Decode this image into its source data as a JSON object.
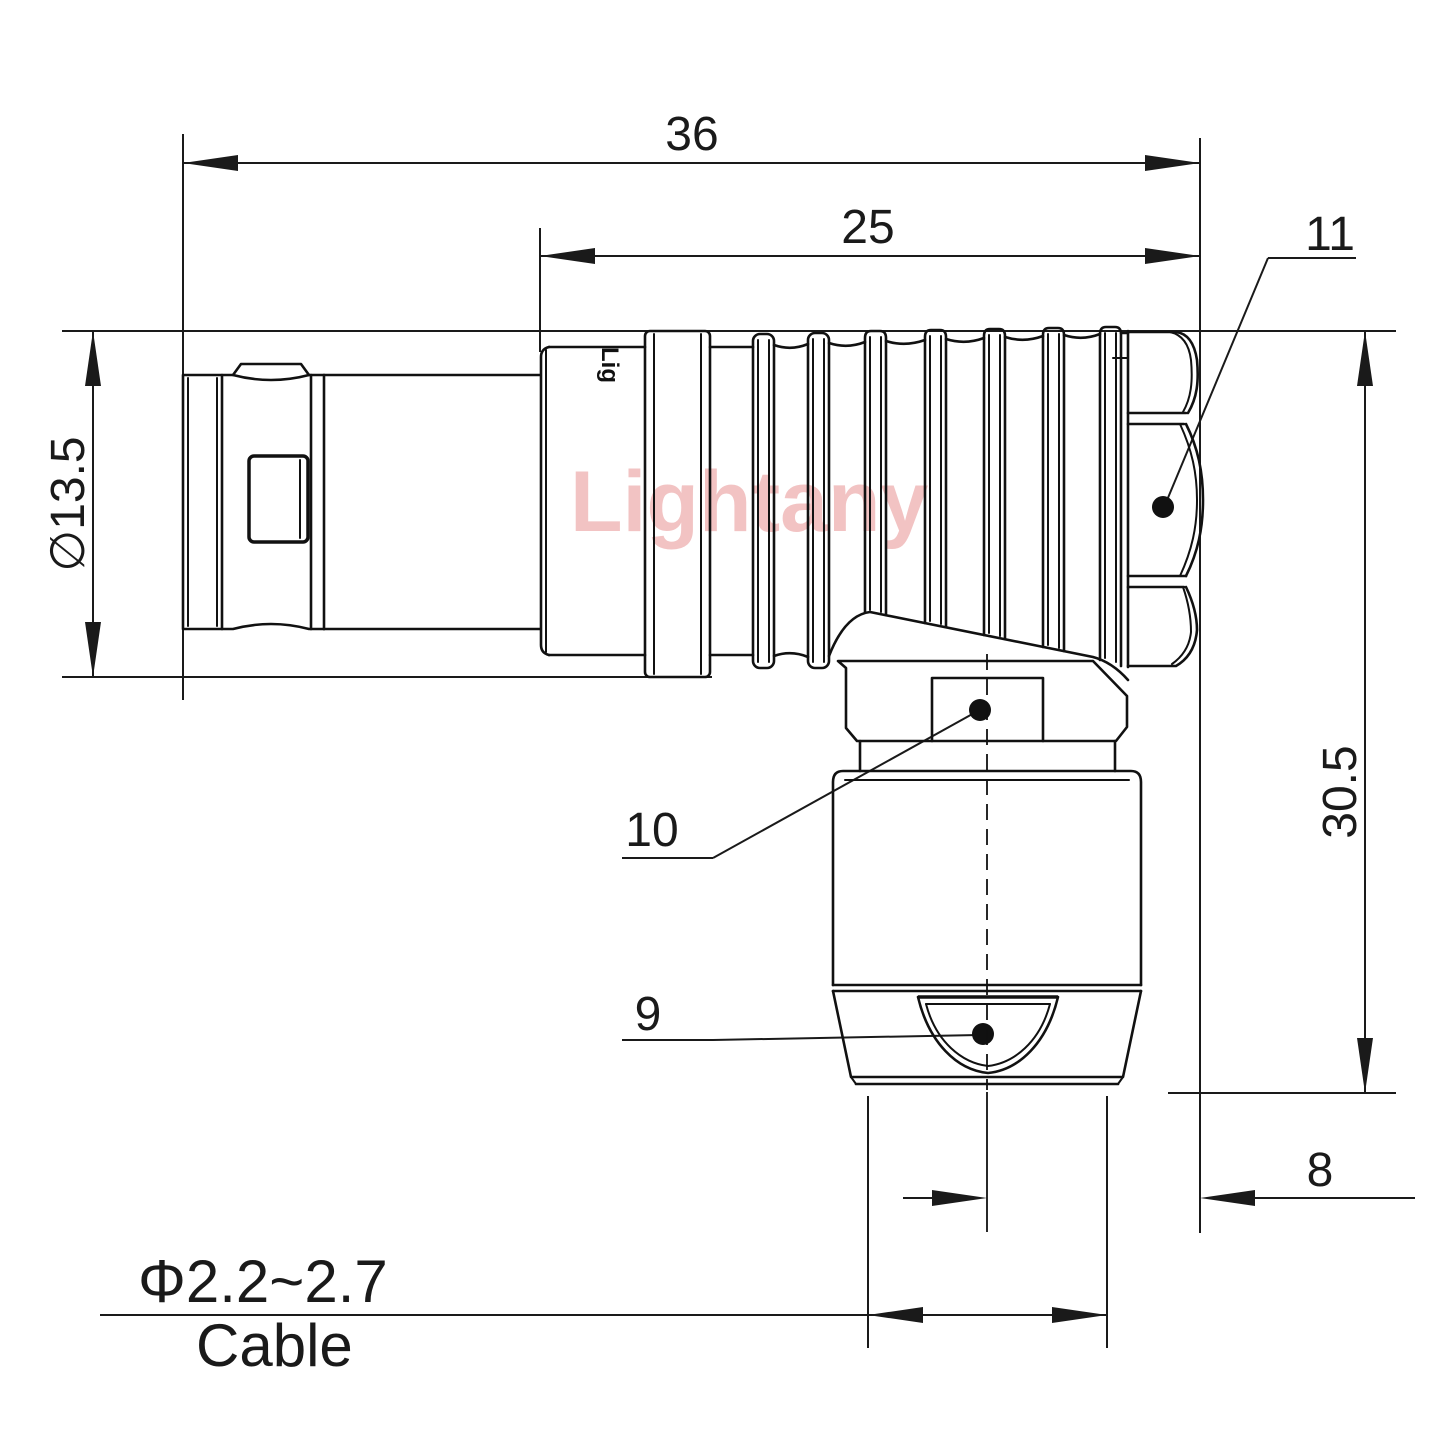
{
  "watermark": "Lightany",
  "brand_mark": "Lig",
  "dimensions": {
    "total_length": "36",
    "rear_length": "25",
    "front_diameter": "∅13.5",
    "total_height": "30.5",
    "nut_width": "8",
    "cable_diameter": "Φ2.2~2.7",
    "cable_label": "Cable"
  },
  "callouts": {
    "coupling_nut": "11",
    "gland_nut": "10",
    "collet": "9"
  }
}
